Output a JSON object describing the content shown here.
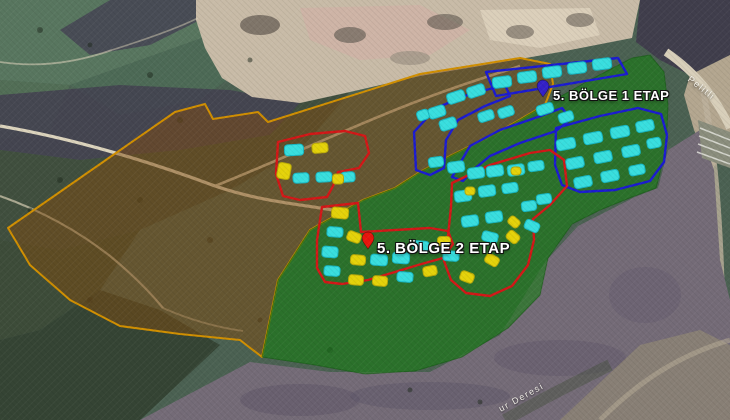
{
  "view": {
    "type": "satellite-map-with-parcel-overlays"
  },
  "labels": {
    "zone1": "5. BÖLGE 1 ETAP",
    "zone2": "5. BÖLGE 2 ETAP",
    "road": "Pelitli",
    "creek": "ur Deresi"
  },
  "colors": {
    "building_cyan": "#38dede",
    "building_cyan_stroke": "#17b6c2",
    "building_yellow": "#e4d20a",
    "building_yellow_stroke": "#b7a708",
    "zone_red": "#d31717",
    "zone_blue": "#1b1bd1",
    "overlay_brown_fill": "rgba(128,76,16,0.50)",
    "overlay_brown_stroke": "#d18f00",
    "overlay_green_fill": "rgba(22,124,18,0.60)",
    "overlay_green_stroke": "rgba(16,90,12,0.55)",
    "pin_zone1": "#3320c8",
    "pin_zone2": "#e8150d"
  },
  "overlays": {
    "brown_area_points": "8,228 175,112 205,104 213,119 258,112 268,122 420,74 520,58 550,64 553,84 545,105 497,133 452,155 420,172 395,188 363,200 310,230 278,280 262,357 240,340 180,334 120,326 70,300 30,265",
    "green_area_points": "632,58 650,55 664,72 668,105 666,150 656,188 632,197 600,210 572,224 548,258 540,295 508,328 462,357 415,371 365,374 315,365 262,357 278,280 310,230 363,200 395,188 420,172 452,155 497,133 545,105 590,80"
  },
  "zones": {
    "blue_outlines": [
      "486,72 618,58 627,74 496,96",
      "416,170 414,132 436,108 470,94 505,85 510,96 485,106 458,120 446,140 444,168 430,175",
      "452,177 470,146 500,130 535,118 562,108 571,119 556,131 520,143 490,156 473,170 463,181",
      "556,128 600,116 638,108 661,114 667,135 664,162 650,181 615,190 580,192 562,185 555,165"
    ],
    "red_outlines": [
      "278,142 310,134 345,131 365,136 369,153 359,168 338,172 333,186 327,197 300,200 283,196 276,174",
      "322,207 358,203 361,232 430,228 448,231 453,244 443,258 418,265 395,272 368,280 342,284 325,282 317,268 317,240",
      "452,183 490,165 530,153 550,150 564,160 567,186 550,205 533,219 534,240 528,265 512,286 490,296 466,293 451,280 444,261 448,236 451,207"
    ]
  },
  "buildings": {
    "cyan": [
      [
        502,
        82,
        19,
        11,
        -7
      ],
      [
        527,
        77,
        19,
        11,
        -7
      ],
      [
        552,
        72,
        19,
        11,
        -7
      ],
      [
        577,
        68,
        19,
        11,
        -7
      ],
      [
        602,
        64,
        19,
        11,
        -7
      ],
      [
        456,
        97,
        18,
        11,
        -18
      ],
      [
        476,
        91,
        18,
        11,
        -18
      ],
      [
        423,
        115,
        12,
        10,
        -18
      ],
      [
        437,
        112,
        17,
        11,
        -18
      ],
      [
        448,
        124,
        17,
        11,
        -18
      ],
      [
        486,
        116,
        16,
        10,
        -18
      ],
      [
        506,
        112,
        16,
        10,
        -18
      ],
      [
        545,
        109,
        17,
        10,
        -18
      ],
      [
        566,
        117,
        15,
        10,
        -18
      ],
      [
        566,
        144,
        19,
        11,
        -11
      ],
      [
        593,
        138,
        19,
        11,
        -11
      ],
      [
        620,
        132,
        19,
        11,
        -11
      ],
      [
        645,
        126,
        18,
        11,
        -11
      ],
      [
        575,
        163,
        18,
        11,
        -11
      ],
      [
        603,
        157,
        18,
        11,
        -11
      ],
      [
        631,
        151,
        18,
        11,
        -11
      ],
      [
        654,
        143,
        14,
        10,
        -11
      ],
      [
        583,
        182,
        18,
        11,
        -11
      ],
      [
        610,
        176,
        18,
        11,
        -11
      ],
      [
        637,
        170,
        16,
        10,
        -11
      ],
      [
        436,
        162,
        15,
        10,
        -8
      ],
      [
        456,
        167,
        17,
        11,
        -8
      ],
      [
        476,
        173,
        17,
        11,
        -8
      ],
      [
        495,
        171,
        17,
        11,
        -8
      ],
      [
        516,
        170,
        17,
        11,
        -8
      ],
      [
        536,
        166,
        16,
        10,
        -8
      ],
      [
        463,
        196,
        17,
        11,
        -8
      ],
      [
        487,
        191,
        17,
        11,
        -8
      ],
      [
        510,
        188,
        16,
        10,
        -8
      ],
      [
        544,
        199,
        15,
        10,
        -8
      ],
      [
        470,
        221,
        17,
        11,
        -8
      ],
      [
        494,
        217,
        17,
        11,
        -8
      ],
      [
        529,
        206,
        15,
        10,
        -8
      ],
      [
        335,
        232,
        16,
        10,
        4
      ],
      [
        330,
        252,
        16,
        11,
        4
      ],
      [
        332,
        271,
        16,
        10,
        4
      ],
      [
        379,
        260,
        17,
        11,
        4
      ],
      [
        401,
        258,
        17,
        11,
        4
      ],
      [
        405,
        277,
        16,
        10,
        4
      ],
      [
        421,
        246,
        16,
        10,
        4
      ],
      [
        451,
        256,
        16,
        10,
        4
      ],
      [
        490,
        237,
        16,
        10,
        14
      ],
      [
        532,
        226,
        15,
        10,
        24
      ],
      [
        294,
        150,
        19,
        11,
        -3
      ],
      [
        301,
        178,
        16,
        10,
        -3
      ],
      [
        324,
        177,
        16,
        10,
        -3
      ],
      [
        348,
        177,
        14,
        10,
        -3
      ]
    ],
    "yellow": [
      [
        320,
        148,
        16,
        10,
        -5
      ],
      [
        284,
        171,
        13,
        16,
        10
      ],
      [
        338,
        179,
        11,
        10,
        0
      ],
      [
        340,
        213,
        17,
        11,
        5
      ],
      [
        354,
        237,
        14,
        10,
        20
      ],
      [
        358,
        260,
        15,
        10,
        5
      ],
      [
        356,
        280,
        15,
        10,
        5
      ],
      [
        380,
        281,
        15,
        10,
        5
      ],
      [
        444,
        241,
        13,
        9,
        0
      ],
      [
        430,
        271,
        14,
        10,
        -10
      ],
      [
        467,
        277,
        14,
        10,
        20
      ],
      [
        492,
        260,
        14,
        10,
        30
      ],
      [
        513,
        237,
        13,
        10,
        40
      ],
      [
        514,
        222,
        12,
        9,
        40
      ],
      [
        470,
        191,
        10,
        8,
        0
      ],
      [
        516,
        171,
        10,
        8,
        0
      ]
    ]
  },
  "pins": [
    {
      "name": "zone1-pin",
      "x": 543,
      "y": 97,
      "color_key": "pin_zone1"
    },
    {
      "name": "zone2-pin",
      "x": 368,
      "y": 249,
      "color_key": "pin_zone2"
    }
  ]
}
